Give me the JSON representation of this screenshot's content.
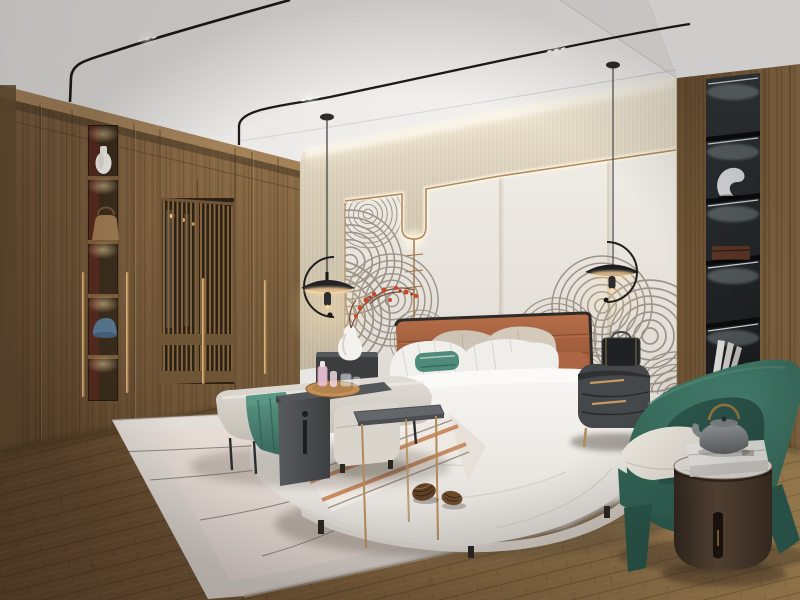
{
  "scene": {
    "type": "interior-photograph",
    "description": "Modern Chinese style bedroom render: walnut wardrobe wall with lit display niche and lattice doors, beige cove-lit fabric band over light panels with brass trim and an ink-wave mural, terracotta leather headboard bed with layered white bedding and teal accents, black disc pendant lights on minimal ceiling tracks, gray bench with charcoal saddle table and drinks tray, pale rug with pinecones, black backlit display column in a wood wall, emerald curved armchair with round oak side table, teapot and gift box, on diagonal plank wood flooring.",
    "style": "new Chinese bedroom, warm neutrals with teal and terracotta accents",
    "objects": [
      {
        "name": "ceiling-track-light-left",
        "note": "black minimal track with LED spots bending down to the wardrobe top"
      },
      {
        "name": "ceiling-track-light-right",
        "note": "black minimal track with LED spots crossing the ceiling"
      },
      {
        "name": "pendant-lamp-left",
        "note": "black disc pendant with C-shaped arm and warm under-glow"
      },
      {
        "name": "pendant-lamp-right",
        "note": "black disc pendant with curved arm and warm under-glow"
      },
      {
        "name": "wardrobe",
        "note": "full-height walnut wardrobe wall with long brass pulls"
      },
      {
        "name": "wardrobe-display-niche",
        "note": "lit shelf column holding a white vase, a handbag and a blue cap"
      },
      {
        "name": "wardrobe-lattice-doors",
        "note": "slatted screen doors with a lit closet interior behind"
      },
      {
        "name": "upper-wall-fabric-band",
        "note": "beige textured wall band washed by cove lighting"
      },
      {
        "name": "feature-wall-panels",
        "note": "light wall panels with backlit brass trim that dips in a U"
      },
      {
        "name": "wave-mural",
        "note": "gray ink-wave swirl mural along the lower wall"
      },
      {
        "name": "red-blossom-branch",
        "note": "red blossom branch over the left nightstand vase"
      },
      {
        "name": "bed",
        "note": "upholstered platform bed with white layered bedding"
      },
      {
        "name": "headboard",
        "note": "terracotta leather headboard with dark trim and seams"
      },
      {
        "name": "pillows",
        "note": "beige back pillows, striped white pillows, teal lumbar, terracotta bolster"
      },
      {
        "name": "striped-throw",
        "note": "white runner with terracotta stripes across the bed foot"
      },
      {
        "name": "nightstand-left",
        "note": "dark drum nightstand with white gourd vase"
      },
      {
        "name": "nightstand-right",
        "note": "gray oval nightstand with brass pulls and a black lantern"
      },
      {
        "name": "bed-bench",
        "note": "light gray upholstered bench with a teal throw"
      },
      {
        "name": "saddle-table",
        "note": "charcoal waterfall table straddling the bench"
      },
      {
        "name": "drinks-tray",
        "note": "round wood tray with pink decanters and glasses"
      },
      {
        "name": "ottoman",
        "note": "light gray pouf at the bed corner"
      },
      {
        "name": "metal-side-table",
        "note": "slim charcoal-top table on tall brass legs"
      },
      {
        "name": "area-rug",
        "note": "pale pink-gray rug with thin curved line motif"
      },
      {
        "name": "pinecones",
        "note": "two pinecones resting on the rug"
      },
      {
        "name": "display-column",
        "note": "black backlit shelf niche with sculpture, wooden box and books"
      },
      {
        "name": "armchair",
        "note": "emerald green curved lounge chair with ivory cushion"
      },
      {
        "name": "round-side-table",
        "note": "dark oak drum table with white marble top"
      },
      {
        "name": "teapot-and-box",
        "note": "gray teapot with brass handle on a white gift box"
      },
      {
        "name": "wood-floor",
        "note": "warm plank flooring laid diagonally"
      }
    ]
  },
  "palette": {
    "ceiling": "#f1efec",
    "wall_beige": "#d9d0bc",
    "wall_panel": "#eae6e0",
    "brass": "#b28a5e",
    "wood_wardrobe": "#8a6a45",
    "wood_wall_right": "#7c5f3c",
    "niche_black": "#212427",
    "headboard": "#a65f3e",
    "bedding": "#f3f1ee",
    "teal_accent": "#4d8a7a",
    "bench_gray": "#d6d1ca",
    "charcoal": "#4b4d4f",
    "rug": "#ded7d1",
    "floor": "#86653f",
    "armchair_green": "#36685a",
    "accent_red": "#c0452c",
    "glow_warm": "#ffd9a0",
    "led_white": "#f2f7f7"
  }
}
